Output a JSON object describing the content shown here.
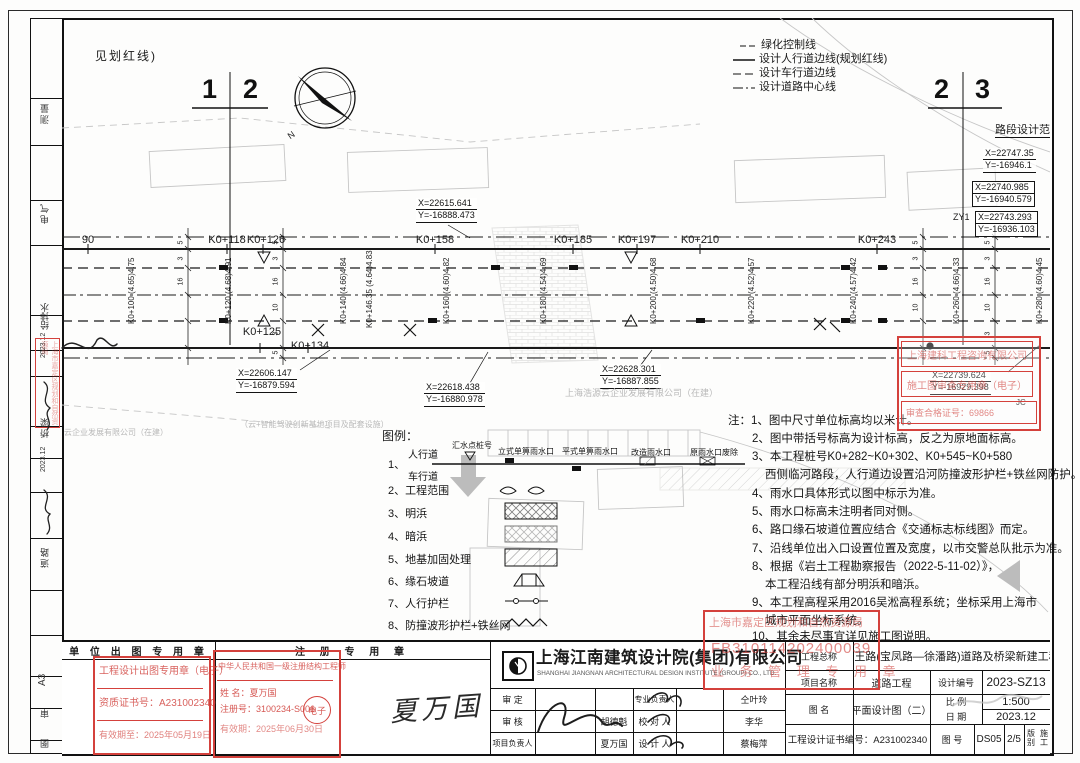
{
  "frame": {
    "top_left_text": "见划红线)",
    "match_left": {
      "a": "1",
      "b": "2"
    },
    "match_right": {
      "a": "2",
      "b": "3"
    },
    "compass_n": "N"
  },
  "side_strip": {
    "discipline_1": "测量",
    "discipline_2": "电气",
    "discipline_3": "给排水",
    "date_1": "2023.12",
    "discipline_4": "桥梁",
    "date_2": "2023.12",
    "discipline_5": "道路",
    "paper_size": "A3",
    "label_review": "审",
    "label_drawing": "图"
  },
  "line_legend": {
    "items": [
      "绿化控制线",
      "设计人行道边线(规划红线)",
      "设计车行道边线",
      "设计道路中心线"
    ]
  },
  "right_margin": {
    "title": "路段设计范围",
    "coord_1": {
      "x": "X=22747.35",
      "y": "Y=-16946.1"
    },
    "coord_2": {
      "x": "X=22740.985",
      "y": "Y=-16940.579"
    },
    "coord_3": {
      "x": "X=22743.293",
      "y": "Y=-16936.103"
    },
    "zy1": "ZY1",
    "jc": "JC"
  },
  "plan": {
    "stations_top": [
      "90",
      "K0+118",
      "K0+126",
      "K0+158",
      "K0+185",
      "K0+197",
      "K0+210",
      "K0+243"
    ],
    "stations_bottom": [
      "K0+125",
      "K0+134"
    ],
    "station_elevations": [
      "K0+100 (4.65)4.75",
      "K0+120 (4.68)4.91",
      "K0+140 (4.66)4.84",
      "K0+146.35 (4.64)4.83",
      "K0+160 (4.60)4.82",
      "K0+180 (4.54)4.69",
      "K0+200 (4.50)4.68",
      "K0+220 (4.52)4.57",
      "K0+240 (4.57)4.42",
      "K0+260 (4.66)4.33",
      "K0+280 (4.60)4.45"
    ],
    "dims": [
      "5",
      "3",
      "16",
      "10",
      "3",
      "5"
    ],
    "coords": [
      {
        "x": "X=22615.641",
        "y": "Y=-16888.473"
      },
      {
        "x": "X=22606.147",
        "y": "Y=-16879.594"
      },
      {
        "x": "X=22618.438",
        "y": "Y=-16880.978"
      },
      {
        "x": "X=22628.301",
        "y": "Y=-16887.855"
      },
      {
        "x": "X=22739.624",
        "y": "Y=-16929.398"
      }
    ],
    "parcel_texts": [
      "上海浩源云企业发展有限公司（在建）",
      "（云+智能驾驶创新基地项目及配套设施）",
      "云企业发展有限公司（在建）"
    ]
  },
  "legend": {
    "title": "图例：",
    "inlet_labels": [
      "汇水点桩号",
      "立式单箅雨水口",
      "平式单箅雨水口",
      "改造雨水口",
      "原雨水口废除"
    ],
    "item1_no": "1、",
    "item1_top": "人行道",
    "item1_bottom": "车行道",
    "items": [
      {
        "no": "2、",
        "label": "工程范围"
      },
      {
        "no": "3、",
        "label": "明浜"
      },
      {
        "no": "4、",
        "label": "暗浜"
      },
      {
        "no": "5、",
        "label": "地基加固处理"
      },
      {
        "no": "6、",
        "label": "缘石坡道"
      },
      {
        "no": "7、",
        "label": "人行护栏"
      },
      {
        "no": "8、",
        "label": "防撞波形护栏+铁丝网"
      }
    ]
  },
  "notes": {
    "lines": [
      "注：1、图中尺寸单位标高均以米计。",
      "2、图中带括号标高为设计标高，反之为原地面标高。",
      "3、本工程桩号K0+282~K0+302、K0+545~K0+580",
      "西侧临河路段，人行道边设置沿河防撞波形护栏+铁丝网防护。",
      "4、雨水口具体形式以图中标示为准。",
      "5、雨水口标高未注明者同对侧。",
      "6、路口缘石坡道位置应结合《交通标志标线图》而定。",
      "7、沿线单位出入口设置位置及宽度，以市交警总队批示为准。",
      "8、根据《岩土工程勘察报告（2022-5-11-02）》，",
      "本工程沿线有部分明浜和暗浜。",
      "9、本工程高程采用2016吴淞高程系统；坐标采用上海市",
      "城市平面坐标系统。",
      "10、其余未尽事宜详见施工图说明。"
    ]
  },
  "stamps": {
    "review": {
      "company": "上海建科工程咨询有限公司",
      "seal": "施工图审查专用章（电子）",
      "cert": "审查合格证号：69866"
    },
    "planning": {
      "authority": "上海市嘉定区规划和自然资源局",
      "number": "FB310114202400039",
      "seal": "业 务 管 理 专 用 章"
    },
    "output": {
      "title": "工程设计出图专用章（电子）",
      "cert": "资质证书号：A231002340",
      "valid": "有效期至：2025年05月19日"
    },
    "registered": {
      "title": "中华人民共和国一级注册结构工程师",
      "name": "姓  名：夏万国",
      "reg_no": "注册号：3100234-S006",
      "valid": "有效期：2025年06月30日",
      "etag": "电子"
    },
    "left_margin": "上海市嘉定区规划和自然资源局"
  },
  "titleblock": {
    "header_left": "单 位 出 图 专 用 章",
    "header_right": "注 册 专 用 章",
    "company_cn": "上海江南建筑设计院(集团)有限公司",
    "company_en": "SHANGHAI JIANGNAN ARCHITECTURAL DESIGN INSTITUTE (GROUP) CO., LTD.",
    "r1c1": "审  定",
    "r1c3": "专业负责人",
    "r1c4": "仝叶玲",
    "r2c1": "审  核",
    "r2c2": "胡德魁",
    "r2c3": "校 对 人",
    "r2c4": "李华",
    "r3c1": "项目负责人",
    "r3c2": "夏万国",
    "r3c3": "设 计 人",
    "r3c4": "蔡梅萍",
    "project_label": "工程总称",
    "project_name": "俞王路(宝凤路—徐潘路)道路及桥梁新建工程",
    "item_label": "项目名称",
    "item_name": "道路工程",
    "design_no_label": "设计编号",
    "design_no": "2023-SZ13",
    "drawing_label": "图  名",
    "drawing_name": "平面设计图（二）",
    "scale_label": "比  例",
    "scale": "1:500",
    "date_label": "日  期",
    "date": "2023.12",
    "cert_line": "工程设计证书编号：A231002340",
    "fig_label": "图  号",
    "fig_no": "DS05",
    "fig_page": "2/5",
    "edition_label": "版 别",
    "edition": "施工",
    "handwritten_signature": "夏万国"
  }
}
